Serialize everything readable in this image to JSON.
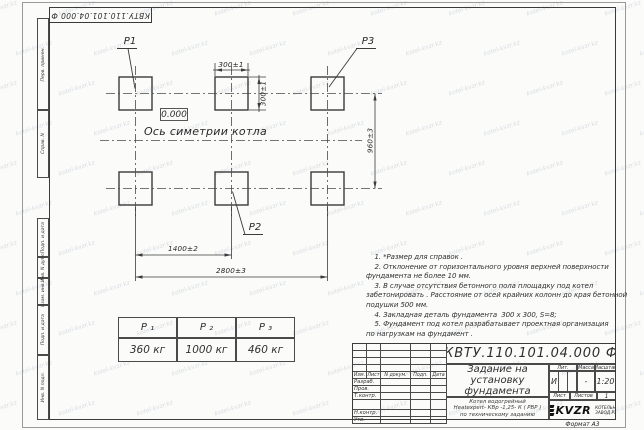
{
  "watermark": {
    "text": "kotel-kvzr.kz"
  },
  "stamp_top": "КВТУ.110.101.04.000  Ф",
  "margin_labels": {
    "group1": [
      "Перв. примен.",
      "Справ. N"
    ],
    "group2": [
      "Подп. и дата",
      "Инв. N дубл.",
      "Взам. инв. N",
      "Подп. и дата",
      "Инв. N подл."
    ]
  },
  "drawing": {
    "leaders": {
      "p1": "P1",
      "p2": "P2",
      "p3": "P3"
    },
    "elevation": "0.000",
    "axis_label": "Ось симетрии котла",
    "dims": {
      "d300h": "300±1",
      "d300v": "300±1",
      "d960": "960±3",
      "d1400": "1400±2",
      "d2800": "2800±3"
    }
  },
  "notes": {
    "lines": [
      "    1. *Размер для справок .",
      "    2. Отклонение от горизонтального уровня верхней поверхности",
      "фундамента не более 10 мм.",
      "    3. В случае отсутствия бетонного пола площадку под котел",
      "забетонировать . Расстояние от осей крайних колонн до края бетонной",
      "подушки 500 мм.",
      "    4. Закладная деталь фундамента  300 х 300, S=8;",
      "    5. Фундамент под котел разрабатывает проектная организация",
      "по нагрузкам на фундамент ."
    ]
  },
  "load_table": {
    "headers": [
      "P ₁",
      "P ₂",
      "P ₃"
    ],
    "values": [
      "360  кг",
      "1000  кг",
      "460  кг"
    ]
  },
  "titleblock": {
    "doc_number": "КВТУ.110.101.04.000  Ф",
    "title_lines": [
      "Задание на",
      "установку",
      "фундамента"
    ],
    "subtitle_lines": [
      "Котел водогрейный",
      "Heatexpert- КВр -1,25- К ( РВР )",
      "по техническому заданию"
    ],
    "header_cols": [
      "Изм.",
      "Лист",
      "N докум.",
      "Подп.",
      "Дата"
    ],
    "sign_rows": [
      "Разраб.",
      "Пров.",
      "Т.контр.",
      "Н.контр.",
      "Утв."
    ],
    "lit_label": "Лит.",
    "mass_label": "Масса",
    "scale_label": "Масштаб",
    "lit_value": "И",
    "mass_value": "-",
    "scale_value": "1:20",
    "sheet_label": "Лист",
    "sheets_label": "Листов",
    "sheets_value": "1",
    "logo_text": "KVZR",
    "logo_caption_lines": [
      "КОТЕЛЬНЫЙ",
      "ЗАВОД РЭП"
    ],
    "format_label": "Формат А3"
  }
}
